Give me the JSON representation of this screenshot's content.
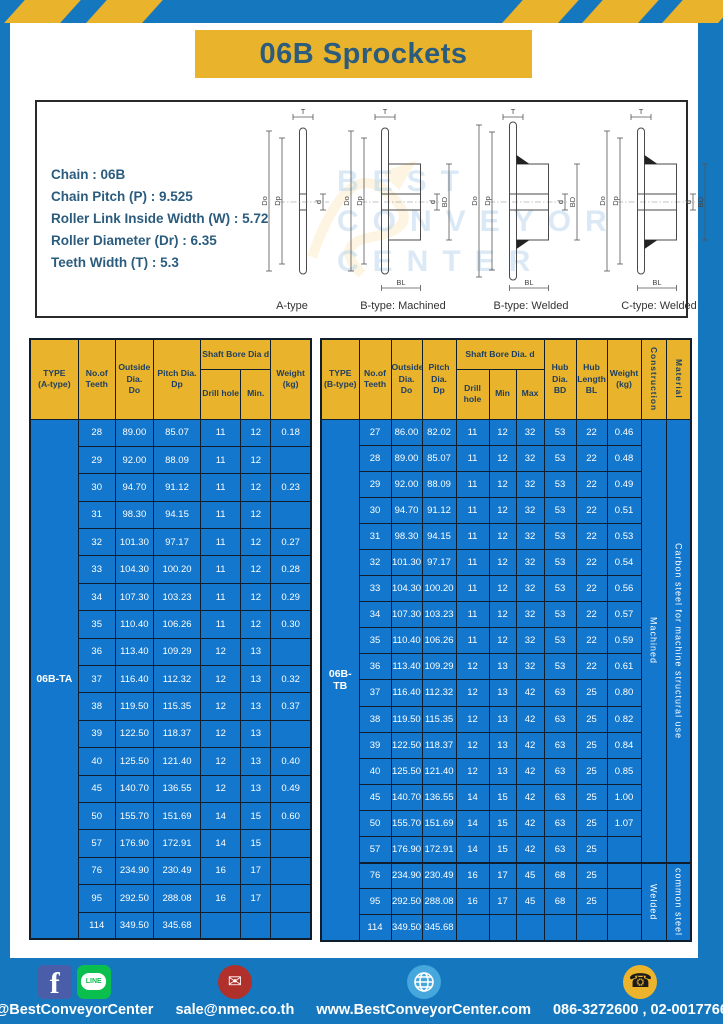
{
  "page": {
    "title": "06B Sprockets"
  },
  "colors": {
    "frame_blue": "#1577bd",
    "cell_blue": "#1277cd",
    "accent_yellow": "#e9b32b",
    "navy_text": "#1e3f60",
    "title_text": "#2b5c7e"
  },
  "specs": {
    "lines": [
      "Chain : 06B",
      "Chain Pitch (P) : 9.525",
      "Roller Link Inside Width (W) : 5.72",
      "Roller Diameter (Dr) : 6.35",
      "Teeth Width (T) : 5.3"
    ]
  },
  "watermark": {
    "lines": [
      "BEST",
      "CONVEYOR",
      "CENTER"
    ]
  },
  "diagram_panel": {
    "figures": [
      {
        "caption": "A-type",
        "kind": "a",
        "labels": {
          "t": "T",
          "do": "Do",
          "dp": "Dp",
          "d": "d"
        }
      },
      {
        "caption": "B-type: Machined",
        "kind": "machined",
        "labels": {
          "t": "T",
          "do": "Do",
          "dp": "Dp",
          "d": "d",
          "bd": "BD",
          "bl": "BL"
        }
      },
      {
        "caption": "B-type: Welded",
        "kind": "welded",
        "labels": {
          "t": "T",
          "do": "Do",
          "dp": "Dp",
          "d": "d",
          "bd": "BD",
          "bl": "BL"
        }
      },
      {
        "caption": "C-type: Welded",
        "kind": "welded2",
        "labels": {
          "t": "T",
          "do": "Do",
          "dp": "Dp",
          "d": "d",
          "bd": "BD",
          "bl": "BL"
        }
      }
    ]
  },
  "tables": {
    "a": {
      "type_label": "06B-TA",
      "headers": {
        "type": "TYPE\n(A-type)",
        "teeth": "No.of\nTeeth",
        "outside": "Outside\nDia.\nDo",
        "pitch": "Pitch Dia.\nDp",
        "shaft_bore": "Shaft Bore Dia d",
        "drill": "Drill hole",
        "min": "Min.",
        "weight": "Weight\n(kg)"
      },
      "rows": [
        [
          "28",
          "89.00",
          "85.07",
          "11",
          "12",
          "0.18"
        ],
        [
          "29",
          "92.00",
          "88.09",
          "11",
          "12",
          ""
        ],
        [
          "30",
          "94.70",
          "91.12",
          "11",
          "12",
          "0.23"
        ],
        [
          "31",
          "98.30",
          "94.15",
          "11",
          "12",
          ""
        ],
        [
          "32",
          "101.30",
          "97.17",
          "11",
          "12",
          "0.27"
        ],
        [
          "33",
          "104.30",
          "100.20",
          "11",
          "12",
          "0.28"
        ],
        [
          "34",
          "107.30",
          "103.23",
          "11",
          "12",
          "0.29"
        ],
        [
          "35",
          "110.40",
          "106.26",
          "11",
          "12",
          "0.30"
        ],
        [
          "36",
          "113.40",
          "109.29",
          "12",
          "13",
          ""
        ],
        [
          "37",
          "116.40",
          "112.32",
          "12",
          "13",
          "0.32"
        ],
        [
          "38",
          "119.50",
          "115.35",
          "12",
          "13",
          "0.37"
        ],
        [
          "39",
          "122.50",
          "118.37",
          "12",
          "13",
          ""
        ],
        [
          "40",
          "125.50",
          "121.40",
          "12",
          "13",
          "0.40"
        ],
        [
          "45",
          "140.70",
          "136.55",
          "12",
          "13",
          "0.49"
        ],
        [
          "50",
          "155.70",
          "151.69",
          "14",
          "15",
          "0.60"
        ],
        [
          "57",
          "176.90",
          "172.91",
          "14",
          "15",
          ""
        ],
        [
          "76",
          "234.90",
          "230.49",
          "16",
          "17",
          ""
        ],
        [
          "95",
          "292.50",
          "288.08",
          "16",
          "17",
          ""
        ],
        [
          "114",
          "349.50",
          "345.68",
          "",
          "",
          ""
        ]
      ]
    },
    "b": {
      "type_label": "06B-TB",
      "headers": {
        "type": "TYPE\n(B-type)",
        "teeth": "No.of\nTeeth",
        "outside": "Outside\nDia.\nDo",
        "pitch": "Pitch\nDia.\nDp",
        "shaft_bore": "Shaft Bore Dia.  d",
        "drill": "Drill hole",
        "min": "Min",
        "max": "Max",
        "hub_dia": "Hub\nDia.\nBD",
        "hub_len": "Hub\nLength\nBL",
        "weight": "Weight\n(kg)",
        "construction": "Construction",
        "material": "Material"
      },
      "rows": [
        [
          "27",
          "86.00",
          "82.02",
          "11",
          "12",
          "32",
          "53",
          "22",
          "0.46"
        ],
        [
          "28",
          "89.00",
          "85.07",
          "11",
          "12",
          "32",
          "53",
          "22",
          "0.48"
        ],
        [
          "29",
          "92.00",
          "88.09",
          "11",
          "12",
          "32",
          "53",
          "22",
          "0.49"
        ],
        [
          "30",
          "94.70",
          "91.12",
          "11",
          "12",
          "32",
          "53",
          "22",
          "0.51"
        ],
        [
          "31",
          "98.30",
          "94.15",
          "11",
          "12",
          "32",
          "53",
          "22",
          "0.53"
        ],
        [
          "32",
          "101.30",
          "97.17",
          "11",
          "12",
          "32",
          "53",
          "22",
          "0.54"
        ],
        [
          "33",
          "104.30",
          "100.20",
          "11",
          "12",
          "32",
          "53",
          "22",
          "0.56"
        ],
        [
          "34",
          "107.30",
          "103.23",
          "11",
          "12",
          "32",
          "53",
          "22",
          "0.57"
        ],
        [
          "35",
          "110.40",
          "106.26",
          "11",
          "12",
          "32",
          "53",
          "22",
          "0.59"
        ],
        [
          "36",
          "113.40",
          "109.29",
          "12",
          "13",
          "32",
          "53",
          "22",
          "0.61"
        ],
        [
          "37",
          "116.40",
          "112.32",
          "12",
          "13",
          "42",
          "63",
          "25",
          "0.80"
        ],
        [
          "38",
          "119.50",
          "115.35",
          "12",
          "13",
          "42",
          "63",
          "25",
          "0.82"
        ],
        [
          "39",
          "122.50",
          "118.37",
          "12",
          "13",
          "42",
          "63",
          "25",
          "0.84"
        ],
        [
          "40",
          "125.50",
          "121.40",
          "12",
          "13",
          "42",
          "63",
          "25",
          "0.85"
        ],
        [
          "45",
          "140.70",
          "136.55",
          "14",
          "15",
          "42",
          "63",
          "25",
          "1.00"
        ],
        [
          "50",
          "155.70",
          "151.69",
          "14",
          "15",
          "42",
          "63",
          "25",
          "1.07"
        ],
        [
          "57",
          "176.90",
          "172.91",
          "14",
          "15",
          "42",
          "63",
          "25",
          ""
        ],
        [
          "76",
          "234.90",
          "230.49",
          "16",
          "17",
          "45",
          "68",
          "25",
          ""
        ],
        [
          "95",
          "292.50",
          "288.08",
          "16",
          "17",
          "45",
          "68",
          "25",
          ""
        ],
        [
          "114",
          "349.50",
          "345.68",
          "",
          "",
          "",
          "",
          "",
          ""
        ]
      ],
      "construction_groups": [
        {
          "label": "Machined",
          "span": 17
        },
        {
          "label": "Welded",
          "span": 3
        }
      ],
      "material_groups": [
        {
          "label": "Carbon  steel  for  machine  structural  use",
          "span": 17
        },
        {
          "label": "common steel",
          "span": 3
        }
      ]
    }
  },
  "footer": {
    "social_handle": "@BestConveyorCenter",
    "email": "sale@nmec.co.th",
    "website": "www.BestConveyorCenter.com",
    "phones": "086-3272600 , 02-0017766",
    "icons": {
      "facebook_glyph": "f",
      "line_label": "LINE",
      "email_glyph": "✉",
      "phone_glyph": "☎"
    }
  }
}
